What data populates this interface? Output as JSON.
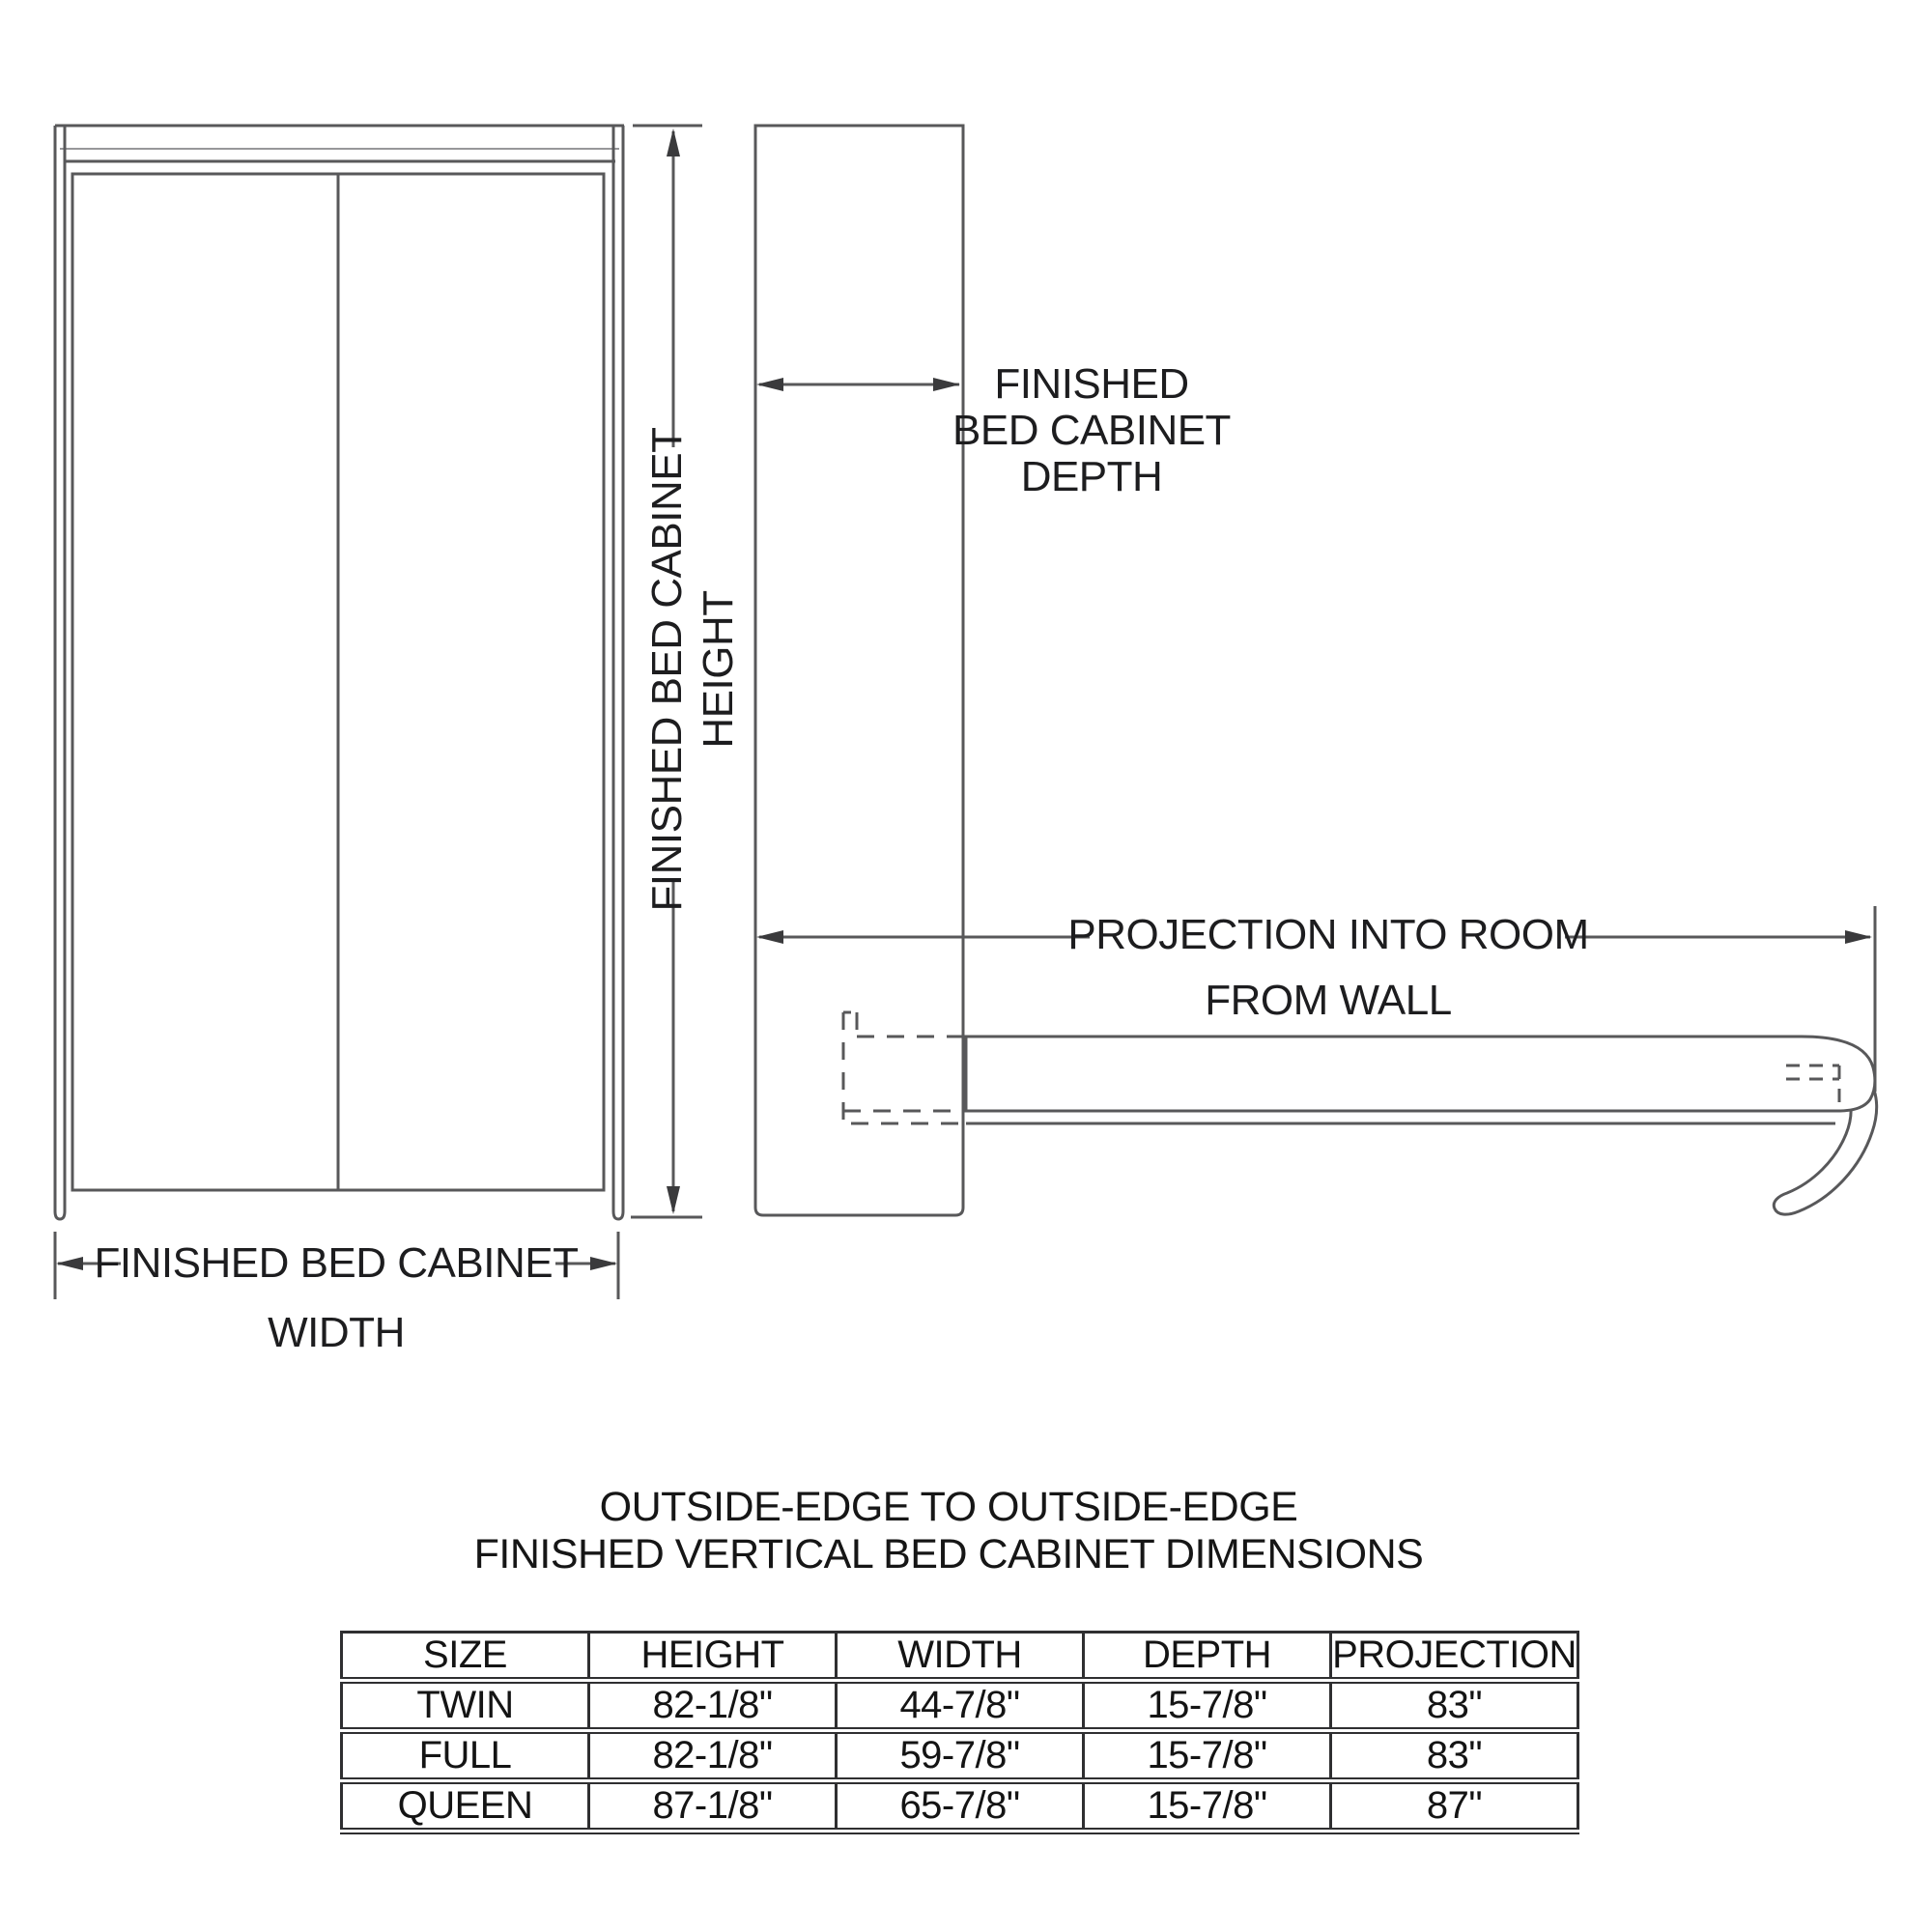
{
  "diagram": {
    "front_view": {
      "width_label_line1": "FINISHED BED CABINET",
      "width_label_line2": "WIDTH",
      "height_label_line1": "FINISHED BED CABINET",
      "height_label_line2": "HEIGHT"
    },
    "side_view": {
      "depth_label_line1": "FINISHED",
      "depth_label_line2": "BED CABINET",
      "depth_label_line3": "DEPTH",
      "projection_label_line1": "PROJECTION INTO ROOM",
      "projection_label_line2": "FROM WALL"
    }
  },
  "table_section": {
    "title_line1": "OUTSIDE-EDGE TO OUTSIDE-EDGE",
    "title_line2": "FINISHED VERTICAL BED CABINET DIMENSIONS",
    "table": {
      "columns": [
        "SIZE",
        "HEIGHT",
        "WIDTH",
        "DEPTH",
        "PROJECTION"
      ],
      "rows": [
        [
          "TWIN",
          "82-1/8\"",
          "44-7/8\"",
          "15-7/8\"",
          "83\""
        ],
        [
          "FULL",
          "82-1/8\"",
          "59-7/8\"",
          "15-7/8\"",
          "83\""
        ],
        [
          "QUEEN",
          "87-1/8\"",
          "65-7/8\"",
          "15-7/8\"",
          "87\""
        ]
      ]
    }
  },
  "colors": {
    "line": "#58585a",
    "text": "#1d1d1f",
    "table_border": "#2f2f31",
    "background": "#ffffff"
  }
}
